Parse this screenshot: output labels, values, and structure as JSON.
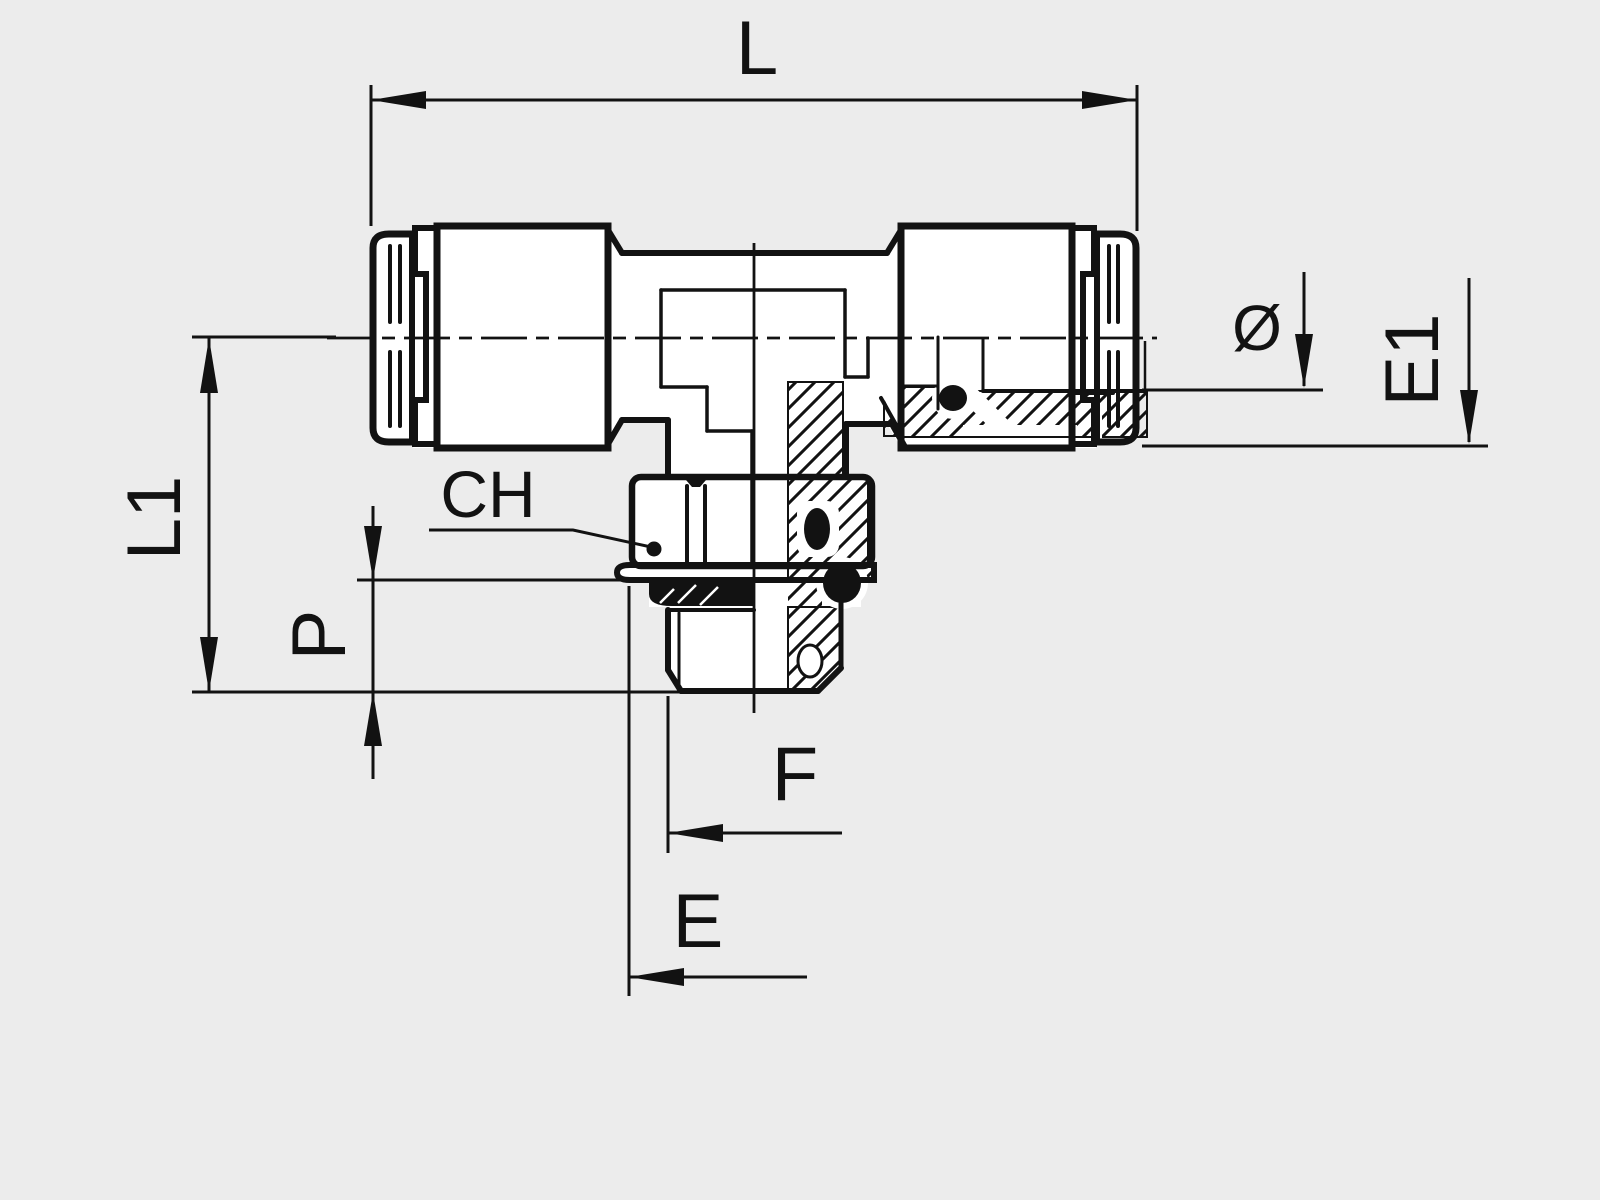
{
  "drawing": {
    "kind": "technical-dimension-drawing",
    "subject": "push-in tee fitting with male threaded stud, half-section side view",
    "background_color": "#ececec",
    "ink_color": "#121212",
    "dims": {
      "L": "L",
      "L1": "L1",
      "P": "P",
      "CH": "CH",
      "F": "F",
      "E": "E",
      "E1": "E1",
      "diameter": "Ø"
    }
  }
}
